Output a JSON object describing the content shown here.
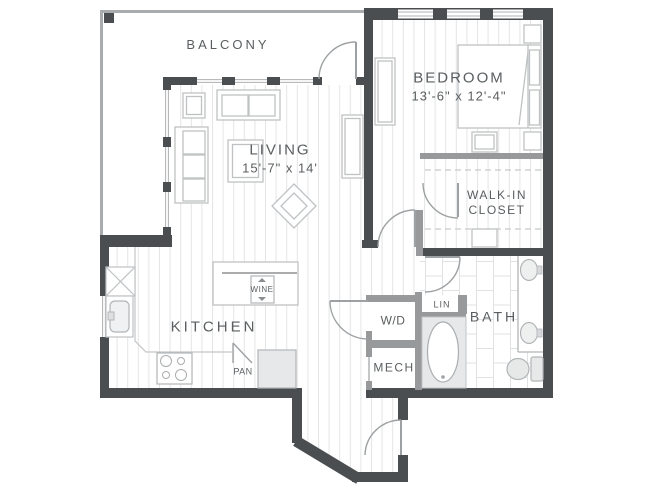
{
  "floorplan": {
    "rooms": {
      "balcony": {
        "label": "BALCONY"
      },
      "living": {
        "label": "LIVING",
        "dimensions": "15'-7\" x 14'"
      },
      "bedroom": {
        "label": "BEDROOM",
        "dimensions": "13'-6\" x 12'-4\""
      },
      "walk_in_closet": {
        "label_line1": "WALK-IN",
        "label_line2": "CLOSET"
      },
      "kitchen": {
        "label": "KITCHEN"
      },
      "bath": {
        "label": "BATH"
      },
      "washer_dryer": {
        "label": "W/D"
      },
      "mechanical": {
        "label": "MECH"
      },
      "linen": {
        "label": "LIN"
      },
      "wine_cooler": {
        "label": "WINE"
      },
      "pantry": {
        "label": "PAN"
      }
    },
    "colors": {
      "wall_dark": "#4b4e50",
      "wall_gray": "#97999b",
      "furniture_line": "#bfc2c4",
      "door_line": "#9ea1a3",
      "plank_line": "#e4e5e6",
      "tile_line": "#e0e2e3",
      "shaded_fill": "#e7e8e9",
      "text": "#5a5e60",
      "background": "#ffffff"
    }
  }
}
